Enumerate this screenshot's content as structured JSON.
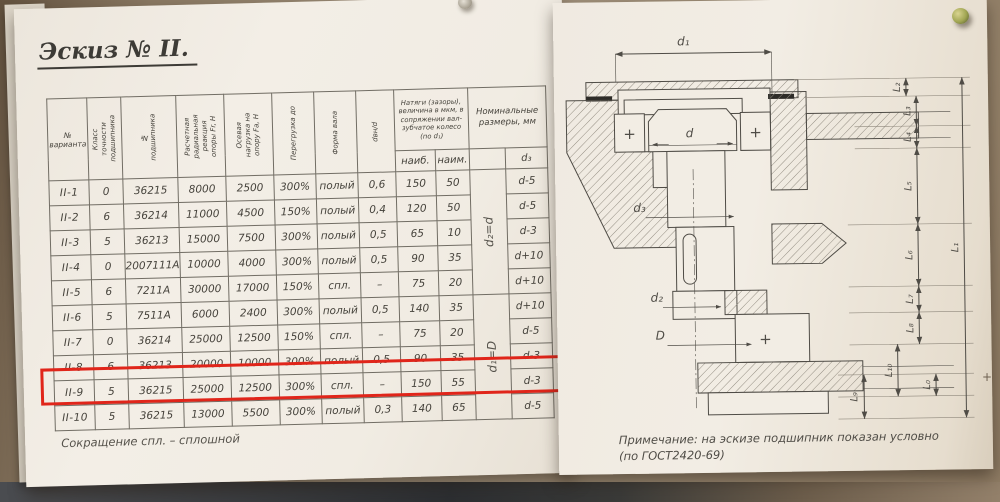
{
  "title": "Эскиз № II.",
  "highlight": {
    "row": "II-9",
    "color": "#e0251a"
  },
  "table": {
    "columns": [
      "№ варианта",
      "Класс точности подшипника",
      "№ подшипника",
      "Расчетная радиальная реакция опоры Fr, Н",
      "Осевая нагрузка на опору Fа, Н",
      "Перегрузка до",
      "Форма вала",
      "dвн/d"
    ],
    "fit_group": {
      "label": "Натяги (зазоры), величина в мкм, в сопряжении вал-зубчатое колесо (по d₁)",
      "sub": [
        "наиб.",
        "наим."
      ]
    },
    "nominal_group": {
      "label": "Номинальные размеры, мм",
      "merged": [
        "d₂=d",
        "d₁=D"
      ],
      "sub": "d₃"
    },
    "rows": [
      {
        "variant": "II-1",
        "accuracy_class": "0",
        "bearing_no": "36215",
        "radial_load": "8000",
        "axial_load": "2500",
        "overload": "300%",
        "shaft_form": "полый",
        "d_ratio": "0,6",
        "fit_max": "150",
        "fit_min": "50",
        "d3": "d-5"
      },
      {
        "variant": "II-2",
        "accuracy_class": "6",
        "bearing_no": "36214",
        "radial_load": "11000",
        "axial_load": "4500",
        "overload": "150%",
        "shaft_form": "полый",
        "d_ratio": "0,4",
        "fit_max": "120",
        "fit_min": "50",
        "d3": "d-5"
      },
      {
        "variant": "II-3",
        "accuracy_class": "5",
        "bearing_no": "36213",
        "radial_load": "15000",
        "axial_load": "7500",
        "overload": "300%",
        "shaft_form": "полый",
        "d_ratio": "0,5",
        "fit_max": "65",
        "fit_min": "10",
        "d3": "d-3"
      },
      {
        "variant": "II-4",
        "accuracy_class": "0",
        "bearing_no": "2007111А",
        "radial_load": "10000",
        "axial_load": "4000",
        "overload": "300%",
        "shaft_form": "полый",
        "d_ratio": "0,5",
        "fit_max": "90",
        "fit_min": "35",
        "d3": "d+10"
      },
      {
        "variant": "II-5",
        "accuracy_class": "6",
        "bearing_no": "7211А",
        "radial_load": "30000",
        "axial_load": "17000",
        "overload": "150%",
        "shaft_form": "спл.",
        "d_ratio": "–",
        "fit_max": "75",
        "fit_min": "20",
        "d3": "d+10"
      },
      {
        "variant": "II-6",
        "accuracy_class": "5",
        "bearing_no": "7511А",
        "radial_load": "6000",
        "axial_load": "2400",
        "overload": "300%",
        "shaft_form": "полый",
        "d_ratio": "0,5",
        "fit_max": "140",
        "fit_min": "35",
        "d3": "d+10"
      },
      {
        "variant": "II-7",
        "accuracy_class": "0",
        "bearing_no": "36214",
        "radial_load": "25000",
        "axial_load": "12500",
        "overload": "150%",
        "shaft_form": "спл.",
        "d_ratio": "–",
        "fit_max": "75",
        "fit_min": "20",
        "d3": "d-5"
      },
      {
        "variant": "II-8",
        "accuracy_class": "6",
        "bearing_no": "36213",
        "radial_load": "20000",
        "axial_load": "10000",
        "overload": "300%",
        "shaft_form": "полый",
        "d_ratio": "0,5",
        "fit_max": "90",
        "fit_min": "35",
        "d3": "d-3"
      },
      {
        "variant": "II-9",
        "accuracy_class": "5",
        "bearing_no": "36215",
        "radial_load": "25000",
        "axial_load": "12500",
        "overload": "300%",
        "shaft_form": "спл.",
        "d_ratio": "–",
        "fit_max": "150",
        "fit_min": "55",
        "d3": "d-3"
      },
      {
        "variant": "II-10",
        "accuracy_class": "5",
        "bearing_no": "36215",
        "radial_load": "13000",
        "axial_load": "5500",
        "overload": "300%",
        "shaft_form": "полый",
        "d_ratio": "0,3",
        "fit_max": "140",
        "fit_min": "65",
        "d3": "d-5"
      }
    ],
    "footnote": "Сокращение спл. – сплошной"
  },
  "drawing": {
    "labels": {
      "d1": "d₁",
      "d": "d",
      "d2": "d₂",
      "d3": "d₃",
      "D": "D",
      "cross": "+"
    },
    "dims": {
      "chain": [
        "L₂",
        "L₃",
        "L₄",
        "L₅",
        "L₆",
        "L₇",
        "L₈"
      ],
      "lower": [
        "L₉",
        "L₁₀",
        "L₀"
      ],
      "overall": "L₁"
    },
    "note_line1": "Примечание: на эскизе подшипник показан условно",
    "note_line2": "(по ГОСТ2420-69)"
  },
  "marks": {
    "plus": "+"
  }
}
